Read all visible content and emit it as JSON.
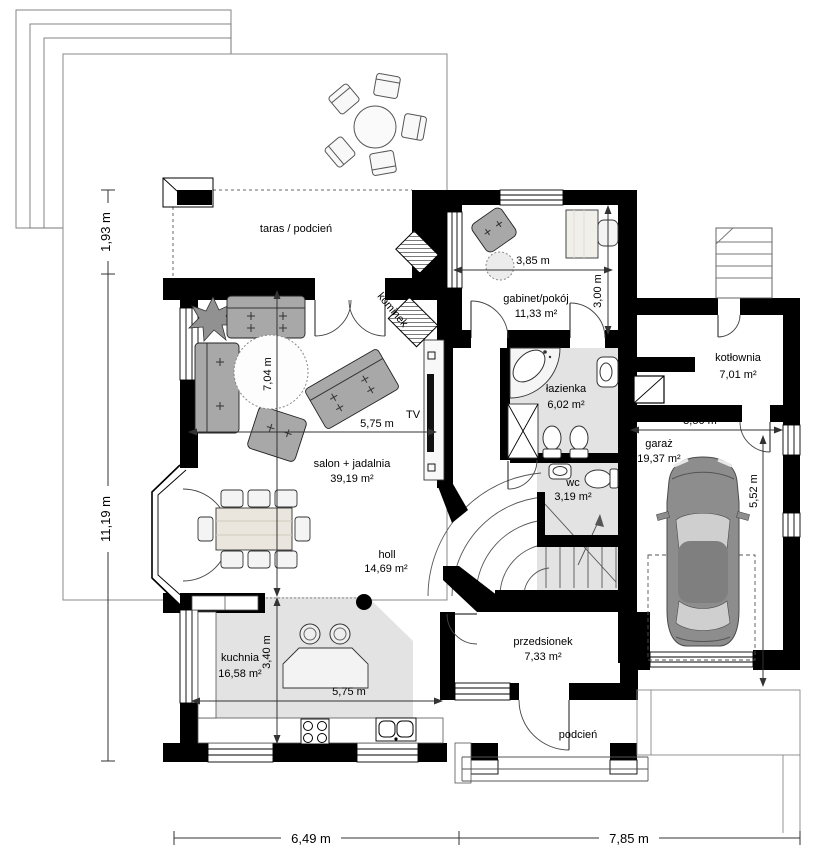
{
  "rooms": {
    "taras": {
      "label": "taras / podcień"
    },
    "gabinet": {
      "label": "gabinet/pokój",
      "area": "11,33 m²"
    },
    "lazienka": {
      "label": "łazienka",
      "area": "6,02 m²"
    },
    "kotlownia": {
      "label": "kotłownia",
      "area": "7,01 m²"
    },
    "wc": {
      "label": "wc",
      "area": "3,19 m²"
    },
    "garaz": {
      "label": "garaż",
      "area": "19,37 m²"
    },
    "salon": {
      "label": "salon + jadalnia",
      "area": "39,19 m²"
    },
    "holl": {
      "label": "holl",
      "area": "14,69 m²"
    },
    "kuchnia": {
      "label": "kuchnia",
      "area": "16,58 m²"
    },
    "przedsionek": {
      "label": "przedsionek",
      "area": "7,33 m²"
    },
    "podcien": {
      "label": "podcień"
    }
  },
  "annotations": {
    "tv": "TV",
    "kominek": "kominek"
  },
  "dimensions": {
    "overhang_depth": "1,93 m",
    "house_depth": "11,19 m",
    "house_width_left": "6,49 m",
    "house_width_right": "7,85 m",
    "gabinet_width": "3,85 m",
    "gabinet_depth": "3,00 m",
    "salon_width": "5,75 m",
    "salon_depth": "7,04 m",
    "kuchnia_width": "5,75 m",
    "kuchnia_depth": "3,40 m",
    "garaz_width": "3,50 m",
    "garaz_depth": "5,52 m"
  },
  "colors": {
    "wall": "#000000",
    "floor": "#e3e3e3",
    "furniture": "#a8a8a8",
    "car_body": "#8d8d8d",
    "line": "#444444"
  }
}
